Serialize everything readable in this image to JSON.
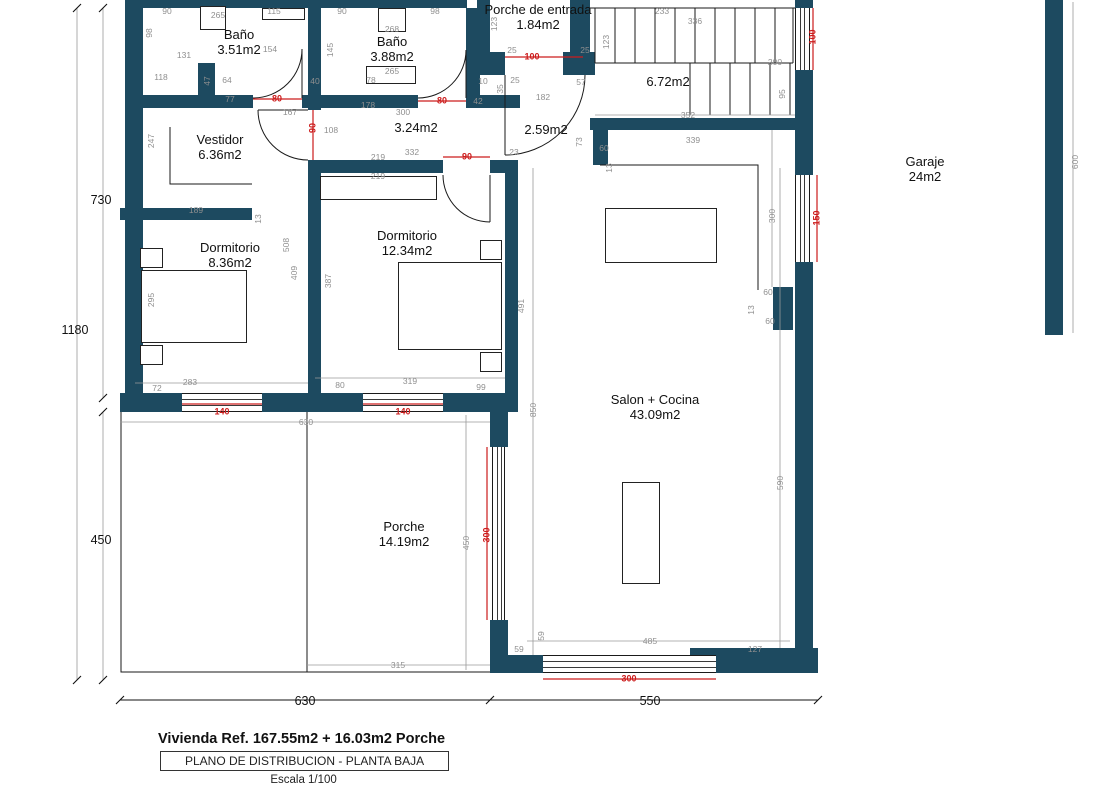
{
  "plan": {
    "colors": {
      "wall": "#1d4a60",
      "opening": "#cc1c1c",
      "dim": "#8f8f8f"
    },
    "title_block": {
      "line1": "Vivienda Ref. 167.55m2 + 16.03m2 Porche",
      "line2": "PLANO DE DISTRIBUCION - PLANTA BAJA",
      "line3": "Escala 1/100"
    },
    "rooms": [
      {
        "name": "Baño",
        "area": "3.51m2",
        "x": 239,
        "y": 27
      },
      {
        "name": "Baño",
        "area": "3.88m2",
        "x": 392,
        "y": 34
      },
      {
        "name": "Porche de entrada",
        "area": "1.84m2",
        "x": 538,
        "y": 2
      },
      {
        "name": "",
        "area": "6.72m2",
        "x": 668,
        "y": 74
      },
      {
        "name": "Vestidor",
        "area": "6.36m2",
        "x": 220,
        "y": 132
      },
      {
        "name": "",
        "area": "3.24m2",
        "x": 416,
        "y": 120
      },
      {
        "name": "",
        "area": "2.59m2",
        "x": 546,
        "y": 122
      },
      {
        "name": "Dormitorio",
        "area": "8.36m2",
        "x": 230,
        "y": 240
      },
      {
        "name": "Dormitorio",
        "area": "12.34m2",
        "x": 407,
        "y": 228
      },
      {
        "name": "Salon + Cocina",
        "area": "43.09m2",
        "x": 655,
        "y": 392
      },
      {
        "name": "Porche",
        "area": "14.19m2",
        "x": 404,
        "y": 519
      },
      {
        "name": "Garaje",
        "area": "24m2",
        "x": 925,
        "y": 154
      }
    ],
    "dims": [
      {
        "t": "90",
        "x": 167,
        "y": 11
      },
      {
        "t": "98",
        "x": 149,
        "y": 33,
        "r": 1
      },
      {
        "t": "131",
        "x": 184,
        "y": 55
      },
      {
        "t": "265",
        "x": 218,
        "y": 15
      },
      {
        "t": "115",
        "x": 274,
        "y": 11
      },
      {
        "t": "154",
        "x": 270,
        "y": 49
      },
      {
        "t": "145",
        "x": 330,
        "y": 50,
        "r": 1
      },
      {
        "t": "118",
        "x": 161,
        "y": 77
      },
      {
        "t": "47",
        "x": 207,
        "y": 81,
        "r": 1
      },
      {
        "t": "64",
        "x": 227,
        "y": 80
      },
      {
        "t": "77",
        "x": 230,
        "y": 99
      },
      {
        "t": "167",
        "x": 290,
        "y": 112
      },
      {
        "t": "90",
        "x": 342,
        "y": 11
      },
      {
        "t": "98",
        "x": 435,
        "y": 11
      },
      {
        "t": "268",
        "x": 392,
        "y": 29
      },
      {
        "t": "40",
        "x": 315,
        "y": 81
      },
      {
        "t": "78",
        "x": 371,
        "y": 80
      },
      {
        "t": "265",
        "x": 392,
        "y": 71
      },
      {
        "t": "178",
        "x": 368,
        "y": 105
      },
      {
        "t": "300",
        "x": 403,
        "y": 112
      },
      {
        "t": "42",
        "x": 478,
        "y": 101
      },
      {
        "t": "108",
        "x": 331,
        "y": 130
      },
      {
        "t": "332",
        "x": 412,
        "y": 152
      },
      {
        "t": "219",
        "x": 378,
        "y": 157
      },
      {
        "t": "219",
        "x": 378,
        "y": 176
      },
      {
        "t": "23",
        "x": 514,
        "y": 152
      },
      {
        "t": "73",
        "x": 579,
        "y": 142,
        "r": 1
      },
      {
        "t": "60",
        "x": 604,
        "y": 148
      },
      {
        "t": "13",
        "x": 609,
        "y": 168,
        "r": 1
      },
      {
        "t": "123",
        "x": 494,
        "y": 24,
        "r": 1
      },
      {
        "t": "25",
        "x": 512,
        "y": 50
      },
      {
        "t": "25",
        "x": 585,
        "y": 50
      },
      {
        "t": "25",
        "x": 515,
        "y": 80
      },
      {
        "t": "35",
        "x": 500,
        "y": 89,
        "r": 1
      },
      {
        "t": "57",
        "x": 581,
        "y": 82
      },
      {
        "t": "182",
        "x": 543,
        "y": 97
      },
      {
        "t": "10",
        "x": 483,
        "y": 81
      },
      {
        "t": "123",
        "x": 606,
        "y": 42,
        "r": 1
      },
      {
        "t": "233",
        "x": 662,
        "y": 11
      },
      {
        "t": "336",
        "x": 695,
        "y": 21
      },
      {
        "t": "200",
        "x": 775,
        "y": 62
      },
      {
        "t": "95",
        "x": 782,
        "y": 94,
        "r": 1
      },
      {
        "t": "352",
        "x": 688,
        "y": 115
      },
      {
        "t": "339",
        "x": 693,
        "y": 140
      },
      {
        "t": "300",
        "x": 772,
        "y": 216,
        "r": 1
      },
      {
        "t": "60",
        "x": 768,
        "y": 292
      },
      {
        "t": "13",
        "x": 751,
        "y": 310,
        "r": 1
      },
      {
        "t": "60",
        "x": 770,
        "y": 321
      },
      {
        "t": "600",
        "x": 1075,
        "y": 162,
        "r": 1
      },
      {
        "t": "247",
        "x": 151,
        "y": 141,
        "r": 1
      },
      {
        "t": "189",
        "x": 196,
        "y": 210
      },
      {
        "t": "13",
        "x": 258,
        "y": 219,
        "r": 1
      },
      {
        "t": "508",
        "x": 286,
        "y": 245,
        "r": 1
      },
      {
        "t": "409",
        "x": 294,
        "y": 273,
        "r": 1
      },
      {
        "t": "387",
        "x": 328,
        "y": 281,
        "r": 1
      },
      {
        "t": "295",
        "x": 151,
        "y": 300,
        "r": 1
      },
      {
        "t": "491",
        "x": 521,
        "y": 306,
        "r": 1
      },
      {
        "t": "283",
        "x": 190,
        "y": 382
      },
      {
        "t": "72",
        "x": 157,
        "y": 388
      },
      {
        "t": "80",
        "x": 340,
        "y": 385
      },
      {
        "t": "319",
        "x": 410,
        "y": 381
      },
      {
        "t": "99",
        "x": 481,
        "y": 387
      },
      {
        "t": "630",
        "x": 306,
        "y": 422
      },
      {
        "t": "850",
        "x": 533,
        "y": 410,
        "r": 1
      },
      {
        "t": "450",
        "x": 466,
        "y": 543,
        "r": 1
      },
      {
        "t": "315",
        "x": 398,
        "y": 665
      },
      {
        "t": "59",
        "x": 541,
        "y": 636,
        "r": 1
      },
      {
        "t": "59",
        "x": 519,
        "y": 649
      },
      {
        "t": "485",
        "x": 650,
        "y": 641
      },
      {
        "t": "127",
        "x": 755,
        "y": 649
      },
      {
        "t": "590",
        "x": 780,
        "y": 483,
        "r": 1
      },
      {
        "t": "80",
        "x": 277,
        "y": 99,
        "c": "r"
      },
      {
        "t": "80",
        "x": 442,
        "y": 101,
        "c": "r"
      },
      {
        "t": "100",
        "x": 532,
        "y": 57,
        "c": "r"
      },
      {
        "t": "90",
        "x": 313,
        "y": 128,
        "r": 1,
        "c": "r"
      },
      {
        "t": "90",
        "x": 467,
        "y": 157,
        "c": "r"
      },
      {
        "t": "100",
        "x": 813,
        "y": 37,
        "r": 1,
        "c": "r"
      },
      {
        "t": "150",
        "x": 817,
        "y": 218,
        "r": 1,
        "c": "r"
      },
      {
        "t": "140",
        "x": 222,
        "y": 412,
        "c": "r"
      },
      {
        "t": "140",
        "x": 403,
        "y": 412,
        "c": "r"
      },
      {
        "t": "300",
        "x": 487,
        "y": 535,
        "r": 1,
        "c": "r"
      },
      {
        "t": "300",
        "x": 629,
        "y": 679,
        "c": "r"
      },
      {
        "t": "730",
        "x": 101,
        "y": 200,
        "c": "k"
      },
      {
        "t": "1180",
        "x": 75,
        "y": 330,
        "c": "k"
      },
      {
        "t": "450",
        "x": 101,
        "y": 540,
        "c": "k"
      },
      {
        "t": "630",
        "x": 305,
        "y": 701,
        "c": "k"
      },
      {
        "t": "550",
        "x": 650,
        "y": 701,
        "c": "k"
      }
    ]
  }
}
